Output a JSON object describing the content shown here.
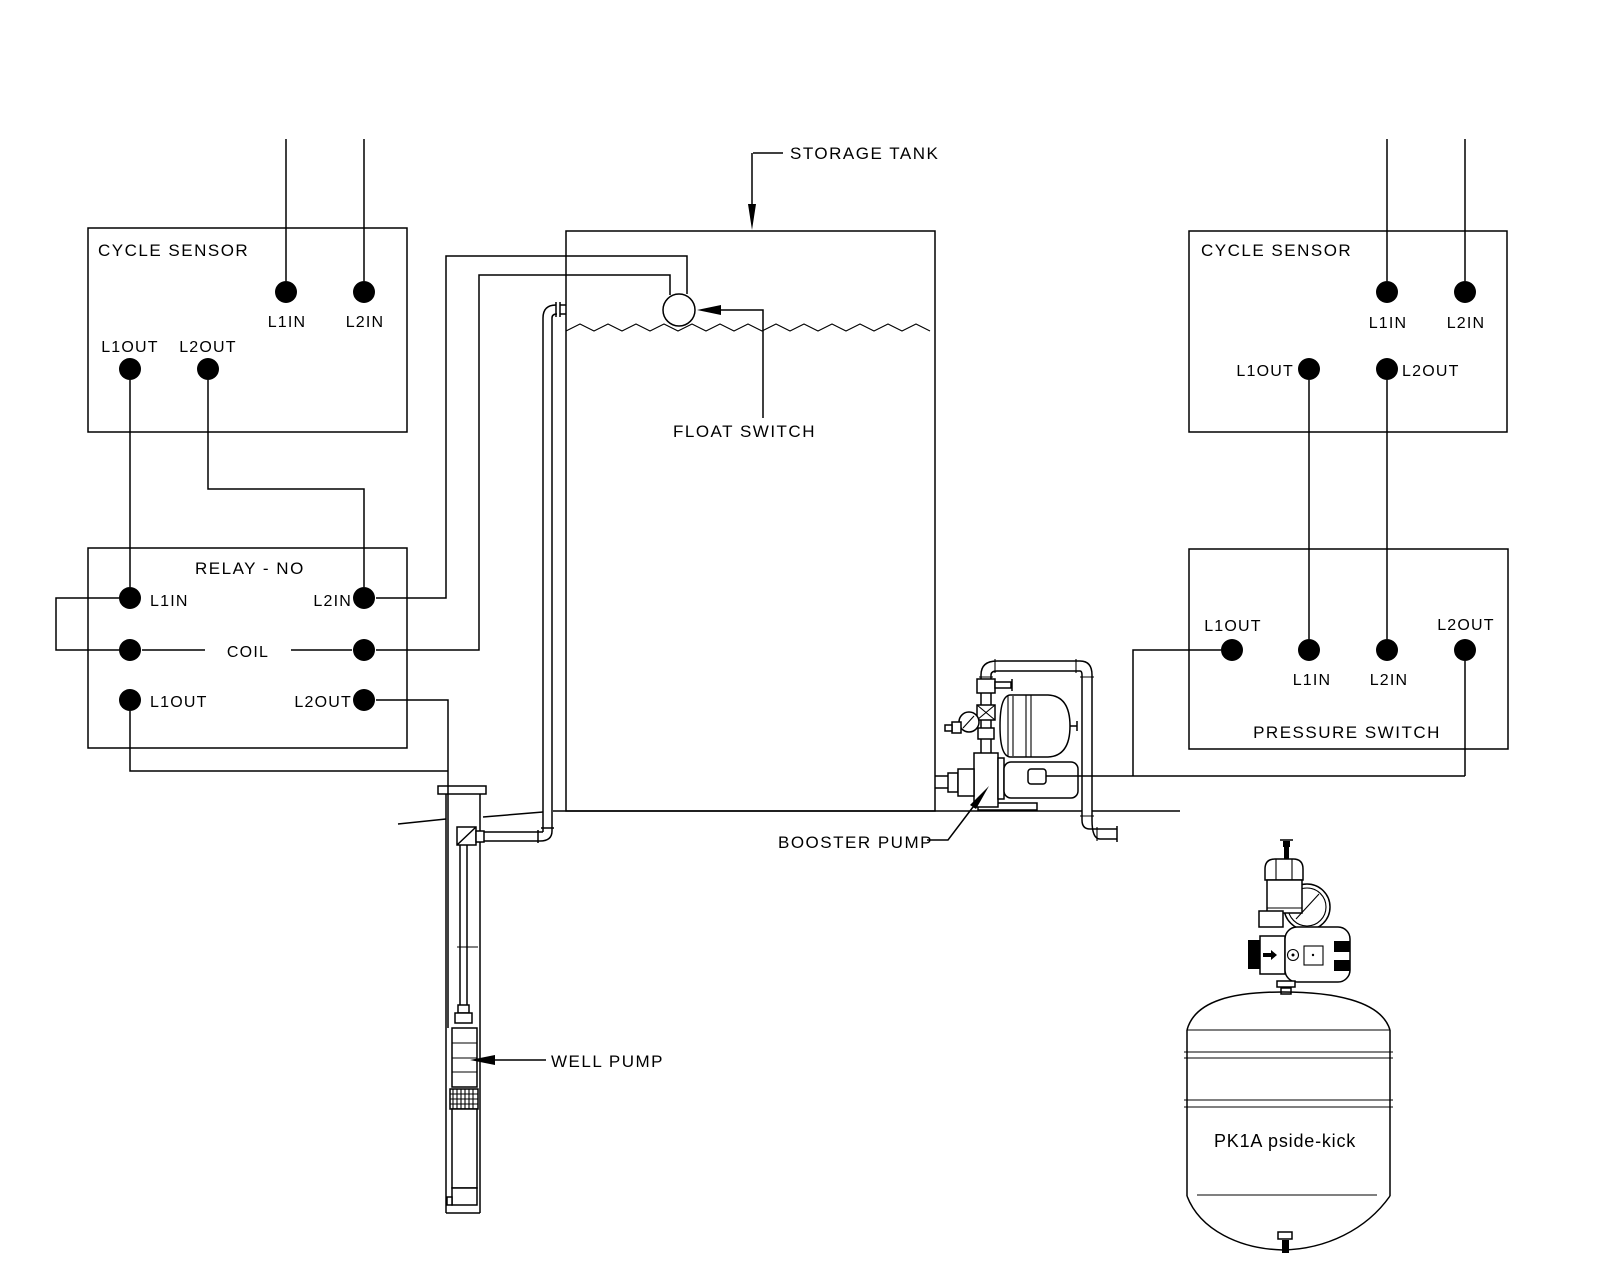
{
  "colors": {
    "ink": "#000000",
    "paper": "#ffffff"
  },
  "cycle_sensor_left": {
    "title": "CYCLE SENSOR",
    "l1in": "L1IN",
    "l2in": "L2IN",
    "l1out": "L1OUT",
    "l2out": "L2OUT"
  },
  "relay": {
    "title": "RELAY - NO",
    "l1in": "L1IN",
    "l2in": "L2IN",
    "coil": "COIL",
    "l1out": "L1OUT",
    "l2out": "L2OUT"
  },
  "cycle_sensor_right": {
    "title": "CYCLE SENSOR",
    "l1in": "L1IN",
    "l2in": "L2IN",
    "l1out": "L1OUT",
    "l2out": "L2OUT"
  },
  "pressure_switch": {
    "title": "PRESSURE SWITCH",
    "l1in": "L1IN",
    "l2in": "L2IN",
    "l1out": "L1OUT",
    "l2out": "L2OUT"
  },
  "annotations": {
    "storage_tank": "STORAGE TANK",
    "float_switch": "FLOAT SWITCH",
    "well_pump": "WELL PUMP",
    "booster_pump": "BOOSTER PUMP",
    "pk1a_tank": "PK1A pside-kick"
  }
}
